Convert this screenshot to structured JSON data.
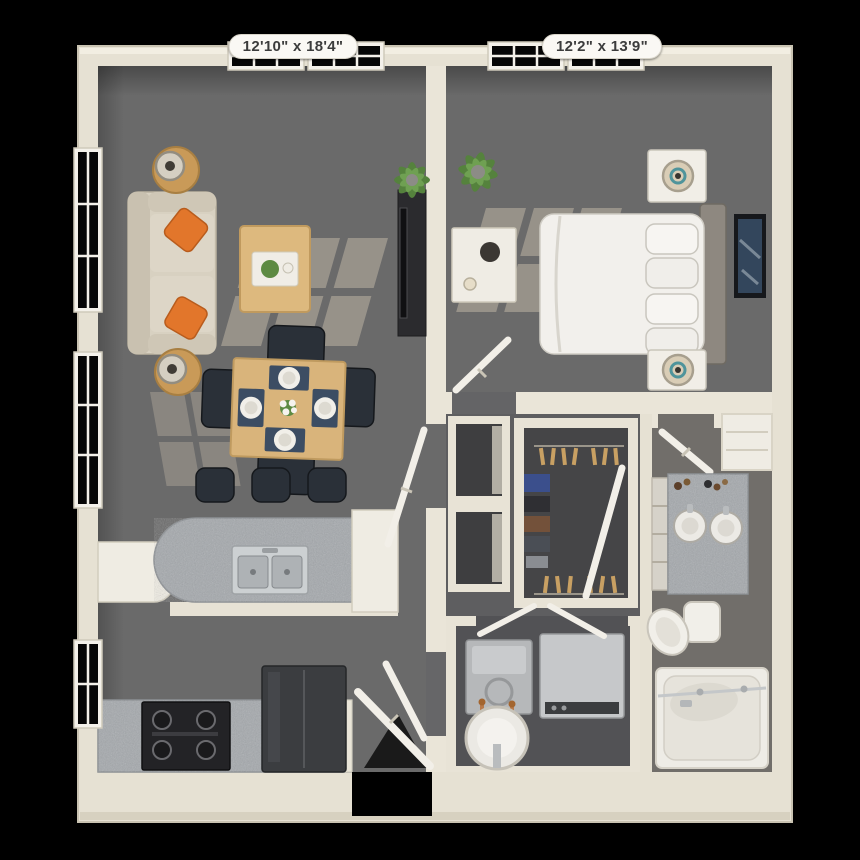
{
  "floorplan": {
    "type": "apartment-3d-floorplan",
    "background": "#000000",
    "rooms": [
      {
        "id": "living-dining-kitchen",
        "dimensions": "12'10\" x 18'4\"",
        "contents": [
          "sofa",
          "throw-pillows",
          "side-tables",
          "table-lamps",
          "coffee-table",
          "tv-console",
          "dining-table",
          "dining-chairs",
          "place-settings",
          "kitchen-island",
          "double-sink",
          "bar-stools",
          "stove",
          "refrigerator",
          "counters",
          "potted-plant",
          "windows"
        ]
      },
      {
        "id": "bedroom",
        "dimensions": "12'2\" x 13'9\"",
        "contents": [
          "bed",
          "pillows",
          "headboard",
          "nightstands",
          "lamps",
          "wall-art",
          "console-table",
          "potted-plant",
          "windows"
        ]
      },
      {
        "id": "walk-in-closet",
        "dimensions": "",
        "contents": [
          "hanging-clothes",
          "hangers",
          "door"
        ]
      },
      {
        "id": "bathroom",
        "dimensions": "",
        "contents": [
          "double-vanity",
          "sinks",
          "toiletries",
          "toilet",
          "bathtub",
          "shower-glass",
          "linen-niche",
          "door"
        ]
      },
      {
        "id": "laundry-closet",
        "dimensions": "",
        "contents": [
          "washer",
          "dryer",
          "water-heater",
          "bifold-doors"
        ]
      },
      {
        "id": "hallway",
        "dimensions": "",
        "contents": [
          "linen-closets",
          "doors"
        ]
      }
    ],
    "labels": {
      "living": "12'10\" x 18'4\"",
      "bedroom": "12'2\" x 13'9\""
    },
    "colors": {
      "wall_cream": "#e6e1d3",
      "wall_light": "#f2eee2",
      "floor_gray": "#6a6a6a",
      "hall_gray": "#5e5e60",
      "closet_dark": "#454547",
      "accent_orange": "#e2762b",
      "wood": "#d9b47b",
      "navy_seating": "#2a3038",
      "granite": "#a4a8ac",
      "stainless": "#ccd0d2",
      "appliance_dark": "#37393c",
      "plant_green": "#55823d",
      "teal_accent": "#4f949b",
      "copper_pipe": "#b87a4b"
    }
  }
}
